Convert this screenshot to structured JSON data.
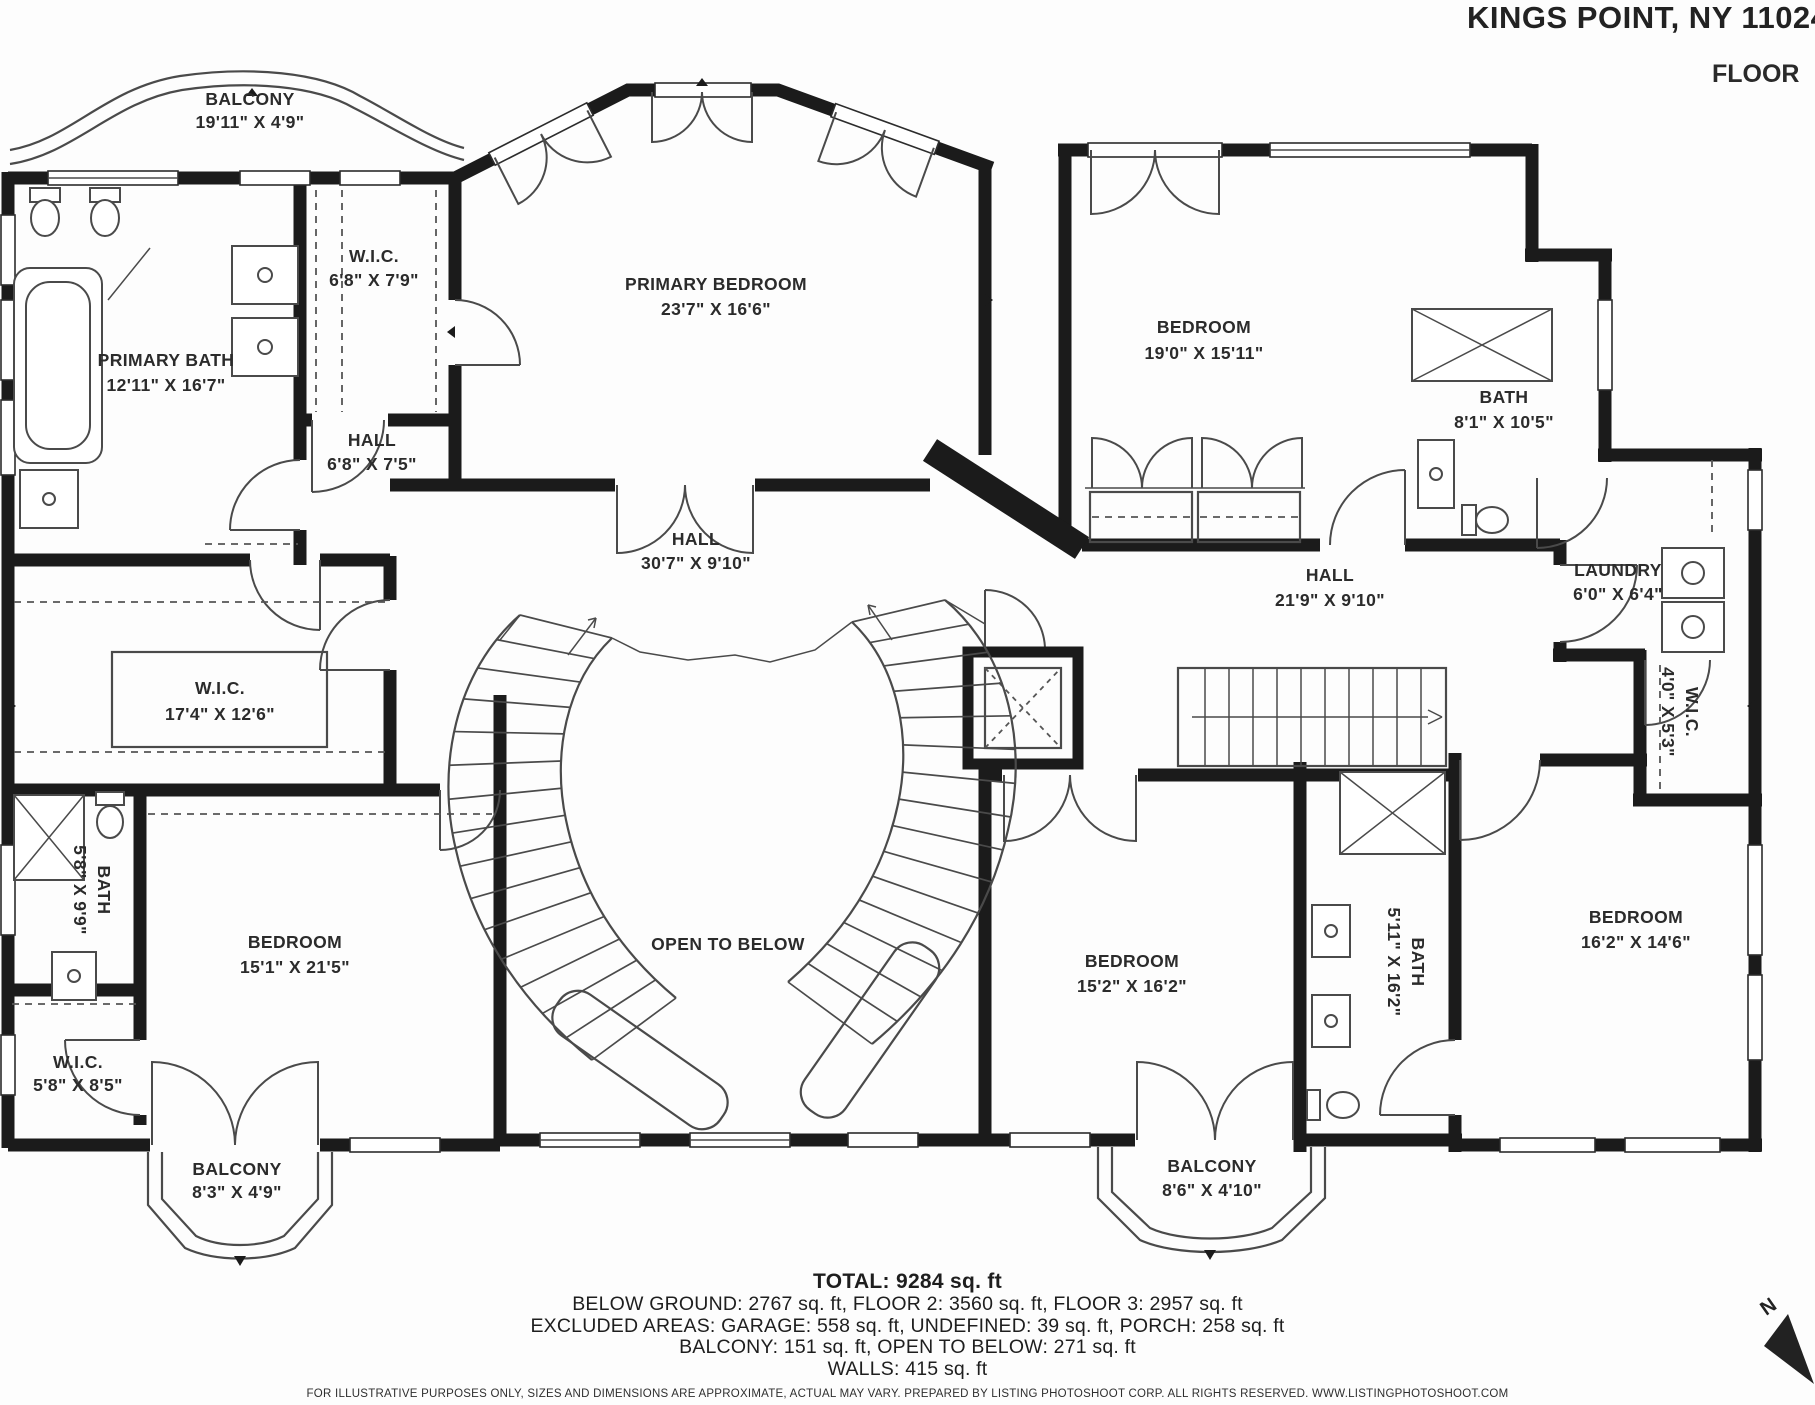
{
  "header": {
    "title": "KINGS POINT, NY 11024",
    "floor_label": "FLOOR"
  },
  "rooms": {
    "balcony_top": {
      "name": "BALCONY",
      "dims": "19'11\" X 4'9\""
    },
    "wic_top": {
      "name": "W.I.C.",
      "dims": "6'8\" X 7'9\""
    },
    "primary_bedroom": {
      "name": "PRIMARY BEDROOM",
      "dims": "23'7\" X 16'6\""
    },
    "bedroom_top_right": {
      "name": "BEDROOM",
      "dims": "19'0\" X 15'11\""
    },
    "primary_bath": {
      "name": "PRIMARY BATH",
      "dims": "12'11\" X 16'7\""
    },
    "hall_small": {
      "name": "HALL",
      "dims": "6'8\" X 7'5\""
    },
    "bath_top_right": {
      "name": "BATH",
      "dims": "8'1\" X 10'5\""
    },
    "hall_center": {
      "name": "HALL",
      "dims": "30'7\" X 9'10\""
    },
    "hall_right": {
      "name": "HALL",
      "dims": "21'9\" X 9'10\""
    },
    "laundry": {
      "name": "LAUNDRY",
      "dims": "6'0\" X 6'4\""
    },
    "wic_left": {
      "name": "W.I.C.",
      "dims": "17'4\" X 12'6\""
    },
    "wic_right": {
      "name": "W.I.C.",
      "dims": "4'0\" X 5'3\""
    },
    "bath_left": {
      "name": "BATH",
      "dims": "5'8\" X 9'9\""
    },
    "bedroom_left": {
      "name": "BEDROOM",
      "dims": "15'1\" X 21'5\""
    },
    "open_to_below": {
      "name": "OPEN TO BELOW"
    },
    "bedroom_bottom_center": {
      "name": "BEDROOM",
      "dims": "15'2\" X 16'2\""
    },
    "bath_bottom": {
      "name": "BATH",
      "dims": "5'11\" X 16'2\""
    },
    "bedroom_right": {
      "name": "BEDROOM",
      "dims": "16'2\" X 14'6\""
    },
    "wic_bottom_left": {
      "name": "W.I.C.",
      "dims": "5'8\" X 8'5\""
    },
    "balcony_bottom_left": {
      "name": "BALCONY",
      "dims": "8'3\" X 4'9\""
    },
    "balcony_bottom_right": {
      "name": "BALCONY",
      "dims": "8'6\" X 4'10\""
    }
  },
  "summary": {
    "total": "TOTAL: 9284 sq. ft",
    "line1": "BELOW GROUND: 2767 sq. ft, FLOOR 2: 3560 sq. ft, FLOOR 3: 2957 sq. ft",
    "line2": "EXCLUDED AREAS: GARAGE: 558 sq. ft, UNDEFINED: 39 sq. ft, PORCH: 258 sq. ft",
    "line3": "BALCONY: 151 sq. ft, OPEN TO BELOW: 271 sq. ft",
    "line4": "WALLS: 415 sq. ft"
  },
  "footer": {
    "disclaimer": "FOR ILLUSTRATIVE PURPOSES ONLY, SIZES AND DIMENSIONS ARE APPROXIMATE, ACTUAL MAY VARY. PREPARED BY LISTING PHOTOSHOOT CORP. ALL RIGHTS RESERVED. WWW.LISTINGPHOTOSHOOT.COM"
  },
  "compass": {
    "label": "N"
  },
  "colors": {
    "wall": "#1b1b1b",
    "line": "#4a4a4a",
    "text": "#2b2b2b"
  }
}
